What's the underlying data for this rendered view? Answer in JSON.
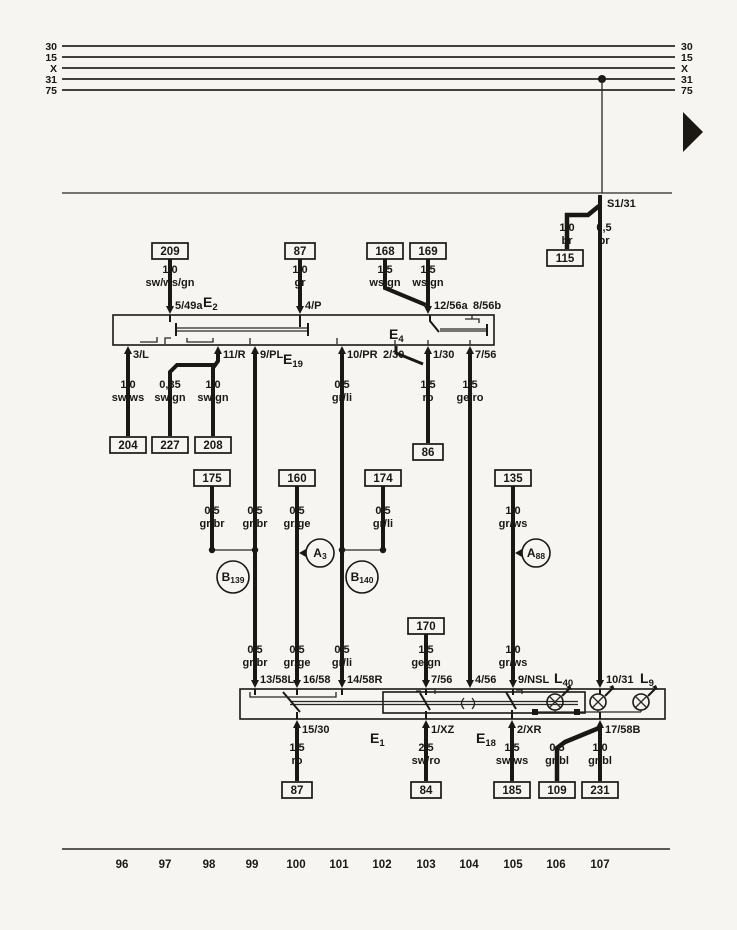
{
  "bus": {
    "left": [
      "30",
      "15",
      "X",
      "31",
      "75"
    ],
    "right": [
      "30",
      "15",
      "X",
      "31",
      "75"
    ]
  },
  "ground": {
    "label": "S1/31"
  },
  "components": {
    "e2": {
      "p": "E",
      "s": "2"
    },
    "e4": {
      "p": "E",
      "s": "4"
    },
    "e19": {
      "p": "E",
      "s": "19"
    },
    "e1": {
      "p": "E",
      "s": "1"
    },
    "e18": {
      "p": "E",
      "s": "18"
    },
    "l40": {
      "p": "L",
      "s": "40"
    },
    "l9": {
      "p": "L",
      "s": "9"
    }
  },
  "splices": {
    "b139": {
      "p": "B",
      "s": "139"
    },
    "a3": {
      "p": "A",
      "s": "3"
    },
    "b140": {
      "p": "B",
      "s": "140"
    },
    "a88": {
      "p": "A",
      "s": "88"
    }
  },
  "terminals": {
    "t5_49a": "5/49a",
    "t4_p": "4/P",
    "t12_56a": "12/56a",
    "t8_56b": "8/56b",
    "t3_l": "3/L",
    "t11_r": "11/R",
    "t9_pl": "9/PL",
    "t10_pr": "10/PR",
    "t2_30": "2/30",
    "t1_30": "1/30",
    "t7_56_top": "7/56",
    "t13_58l": "13/58L",
    "t16_58": "16/58",
    "t14_58r": "14/58R",
    "t7_56_bot": "7/56",
    "t4_56": "4/56",
    "t9_nsl": "9/NSL",
    "t10_31": "10/31",
    "t15_30": "15/30",
    "t1_xz": "1/XZ",
    "t2_xr": "2/XR",
    "t17_58b": "17/58B"
  },
  "connectors": {
    "c209": "209",
    "c87_top": "87",
    "c168": "168",
    "c169": "169",
    "c115": "115",
    "c204": "204",
    "c227": "227",
    "c208": "208",
    "c86": "86",
    "c175": "175",
    "c160": "160",
    "c174": "174",
    "c135": "135",
    "c170": "170",
    "c87_bot": "87",
    "c84": "84",
    "c185": "185",
    "c109": "109",
    "c231": "231"
  },
  "wires": {
    "w209": {
      "size": "1,0",
      "color": "sw/ws/gn"
    },
    "w87": {
      "size": "1,0",
      "color": "gr"
    },
    "w168": {
      "size": "1,5",
      "color": "ws/gn"
    },
    "w169": {
      "size": "1,5",
      "color": "ws/gn"
    },
    "w115": {
      "size": "1,0",
      "color": "br"
    },
    "wbr": {
      "size": "0,5",
      "color": "br"
    },
    "w204": {
      "size": "1,0",
      "color": "sw/ws"
    },
    "w227": {
      "size": "0,35",
      "color": "sw/gn"
    },
    "w208": {
      "size": "1,0",
      "color": "sw/gn"
    },
    "wgrli_a": {
      "size": "0,5",
      "color": "gr/li"
    },
    "w86": {
      "size": "1,5",
      "color": "ro"
    },
    "wgero": {
      "size": "1,5",
      "color": "ge/ro"
    },
    "w175": {
      "size": "0,5",
      "color": "gr/br"
    },
    "wgrbr_b": {
      "size": "0,5",
      "color": "gr/br"
    },
    "w160": {
      "size": "0,5",
      "color": "gr/ge"
    },
    "w174": {
      "size": "0,5",
      "color": "gr/li"
    },
    "w135": {
      "size": "1,0",
      "color": "gr/ws"
    },
    "wgrbr_c": {
      "size": "0,5",
      "color": "gr/br"
    },
    "wgrge_b": {
      "size": "0,5",
      "color": "gr/ge"
    },
    "wgrli_b": {
      "size": "0,5",
      "color": "gr/li"
    },
    "w170": {
      "size": "1,5",
      "color": "ge/gn"
    },
    "wgrws_b": {
      "size": "1,0",
      "color": "gr/ws"
    },
    "w87b": {
      "size": "1,5",
      "color": "ro"
    },
    "w84": {
      "size": "2,5",
      "color": "sw/ro"
    },
    "w185": {
      "size": "1,5",
      "color": "sw/ws"
    },
    "w109": {
      "size": "0,5",
      "color": "gr/bl"
    },
    "w231": {
      "size": "1,0",
      "color": "gr/bl"
    }
  },
  "tracks": [
    "96",
    "97",
    "98",
    "99",
    "100",
    "101",
    "102",
    "103",
    "104",
    "105",
    "106",
    "107"
  ]
}
